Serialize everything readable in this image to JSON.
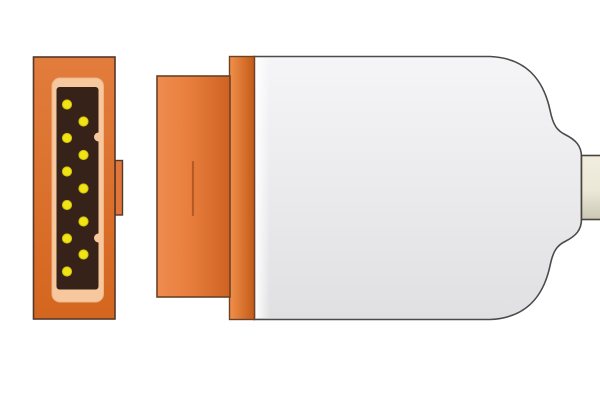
{
  "image": {
    "background": "#ffffff"
  },
  "colors": {
    "outline_brown": "#54382a",
    "outline_gray": "#4a4a4a",
    "face_orange_top": "#e27c3c",
    "face_orange_bottom": "#d4661f",
    "tab_orange": "#e2763a",
    "frame_peach": "#f7c89e",
    "frame_peach_edge": "#ecb487",
    "pin_area_brown": "#362218",
    "pin_yellow": "#f0e414",
    "pin_yellow_edge": "#cdbf0e",
    "plug_light": "#ef8c50",
    "plug_mid": "#e87e3d",
    "plug_dark": "#cd6222",
    "plug_outline": "#6b4226",
    "slot_orange": "#b65a24",
    "strip_light": "#f1914b",
    "strip_dark": "#c35a18",
    "shell_top": "#f5f5f7",
    "shell_bottom": "#e0e0e2",
    "shell_highlight": "#ffffff",
    "cable_top": "#f1eddf",
    "cable_mid": "#ece8d8",
    "cable_bottom": "#cbc7b4",
    "cable_outline": "#47453c"
  },
  "connector_face": {
    "pin_count": 11,
    "pin_radius": 4.6,
    "pins": [
      {
        "cx": 67,
        "cy": 104.5
      },
      {
        "cx": 83.5,
        "cy": 121.5
      },
      {
        "cx": 67,
        "cy": 138
      },
      {
        "cx": 83.5,
        "cy": 155
      },
      {
        "cx": 67,
        "cy": 171.5
      },
      {
        "cx": 83.5,
        "cy": 188.5
      },
      {
        "cx": 67,
        "cy": 205
      },
      {
        "cx": 83.5,
        "cy": 221.5
      },
      {
        "cx": 67,
        "cy": 238.5
      },
      {
        "cx": 83.5,
        "cy": 254.5
      },
      {
        "cx": 67,
        "cy": 271.5
      }
    ],
    "notch_radius": 4.5,
    "notches": [
      {
        "cx": 98.5,
        "cy": 137
      },
      {
        "cx": 98.5,
        "cy": 238
      }
    ]
  }
}
